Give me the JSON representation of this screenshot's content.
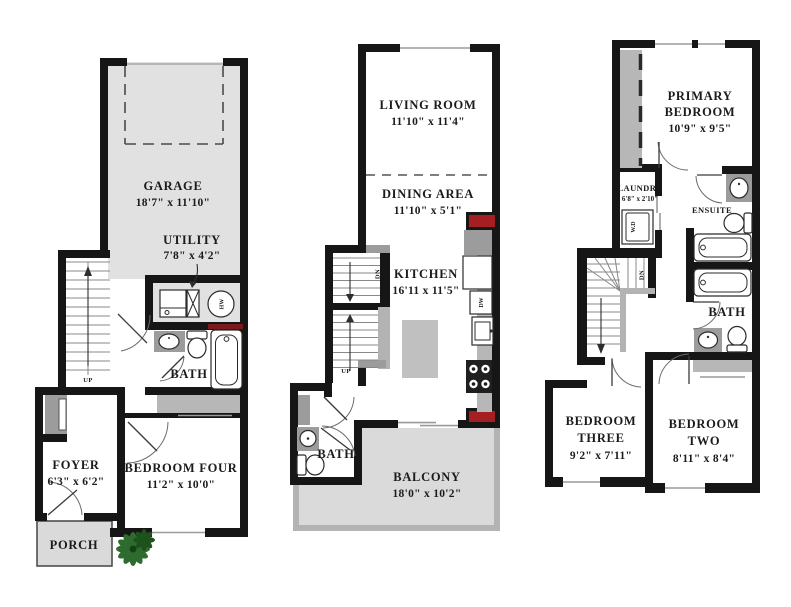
{
  "colors": {
    "wall": "#161616",
    "floor_shade": "#e1e1e1",
    "counter_gray": "#9c9c9c",
    "accent_red": "#a51e22",
    "dark_red": "#7a1a1a",
    "plant_green": "#2e6b2e"
  },
  "floor1": {
    "garage": {
      "name": "GARAGE",
      "dims": "18'7\" x 11'10\""
    },
    "utility": {
      "name": "UTILITY",
      "dims": "7'8\" x 4'2\""
    },
    "bath": {
      "name": "BATH"
    },
    "foyer": {
      "name": "FOYER",
      "dims": "6'3\" x 6'2\""
    },
    "bedroom_four": {
      "name": "BEDROOM FOUR",
      "dims": "11'2\" x 10'0\""
    },
    "porch": {
      "name": "PORCH"
    },
    "labels": {
      "up": "UP",
      "hw": "HW"
    }
  },
  "floor2": {
    "living_room": {
      "name": "LIVING ROOM",
      "dims": "11'10\" x 11'4\""
    },
    "dining_area": {
      "name": "DINING AREA",
      "dims": "11'10\" x 5'1\""
    },
    "kitchen": {
      "name": "KITCHEN",
      "dims": "16'11 x 11'5\""
    },
    "bath": {
      "name": "BATH"
    },
    "balcony": {
      "name": "BALCONY",
      "dims": "18'0\" x 10'2\""
    },
    "labels": {
      "up": "UP",
      "dn": "DN",
      "dw": "DW"
    }
  },
  "floor3": {
    "primary_bedroom": {
      "line1": "PRIMARY",
      "line2": "BEDROOM",
      "dims": "10'9\" x 9'5\""
    },
    "laundry": {
      "name": "LAUNDRY",
      "dims": "6'8\" x 2'10\""
    },
    "ensuite": {
      "name": "ENSUITE"
    },
    "bath": {
      "name": "BATH"
    },
    "bedroom_three": {
      "line1": "BEDROOM",
      "line2": "THREE",
      "dims": "9'2\" x 7'11\""
    },
    "bedroom_two": {
      "line1": "BEDROOM",
      "line2": "TWO",
      "dims": "8'11\" x 8'4\""
    },
    "labels": {
      "dn": "DN",
      "wd": "W.D"
    }
  }
}
